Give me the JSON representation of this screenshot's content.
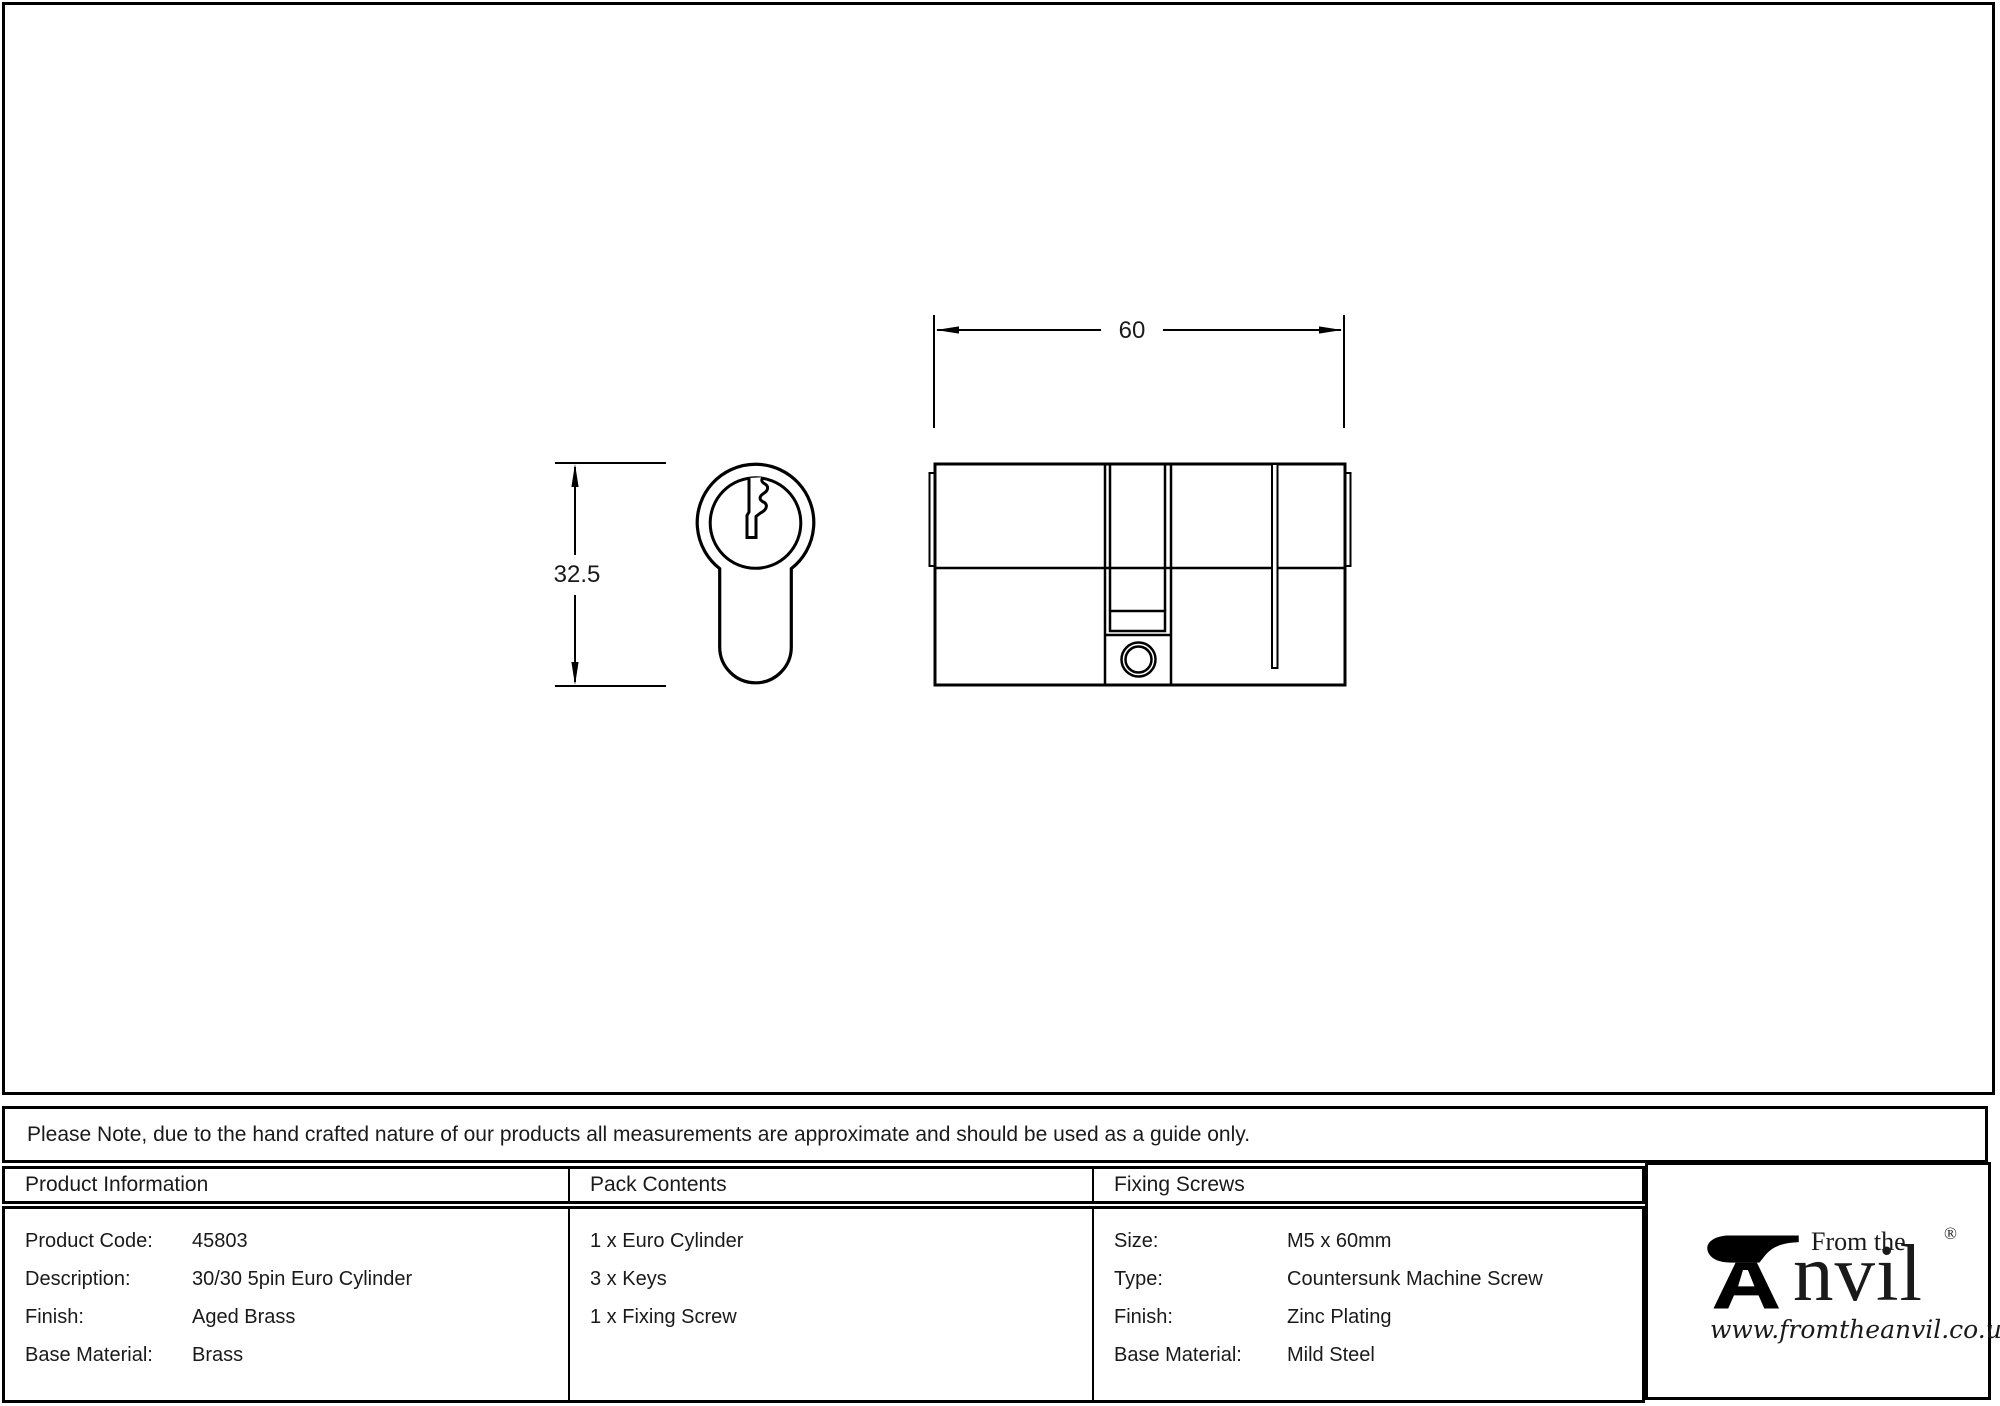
{
  "dimensions": {
    "width_label": "60",
    "height_label": "32.5"
  },
  "note": "Please Note, due to the hand crafted nature of our products all measurements are approximate and should be used as a guide only.",
  "columns": {
    "product_information": {
      "title": "Product Information",
      "rows": [
        {
          "label": "Product Code:",
          "value": "45803"
        },
        {
          "label": "Description:",
          "value": "30/30 5pin Euro Cylinder"
        },
        {
          "label": "Finish:",
          "value": "Aged Brass"
        },
        {
          "label": "Base Material:",
          "value": "Brass"
        }
      ]
    },
    "pack_contents": {
      "title": "Pack Contents",
      "items": [
        "1 x Euro Cylinder",
        "3 x Keys",
        "1 x Fixing Screw"
      ]
    },
    "fixing_screws": {
      "title": "Fixing Screws",
      "rows": [
        {
          "label": "Size:",
          "value": "M5 x 60mm"
        },
        {
          "label": "Type:",
          "value": "Countersunk Machine Screw"
        },
        {
          "label": "Finish:",
          "value": "Zinc Plating"
        },
        {
          "label": "Base Material:",
          "value": "Mild Steel"
        }
      ]
    }
  },
  "logo": {
    "tagline": "From the",
    "brand_rest": "nvil",
    "registered": "®",
    "website": "www.fromtheanvil.co.uk"
  },
  "colors": {
    "ink": "#000000",
    "paper": "#ffffff"
  }
}
